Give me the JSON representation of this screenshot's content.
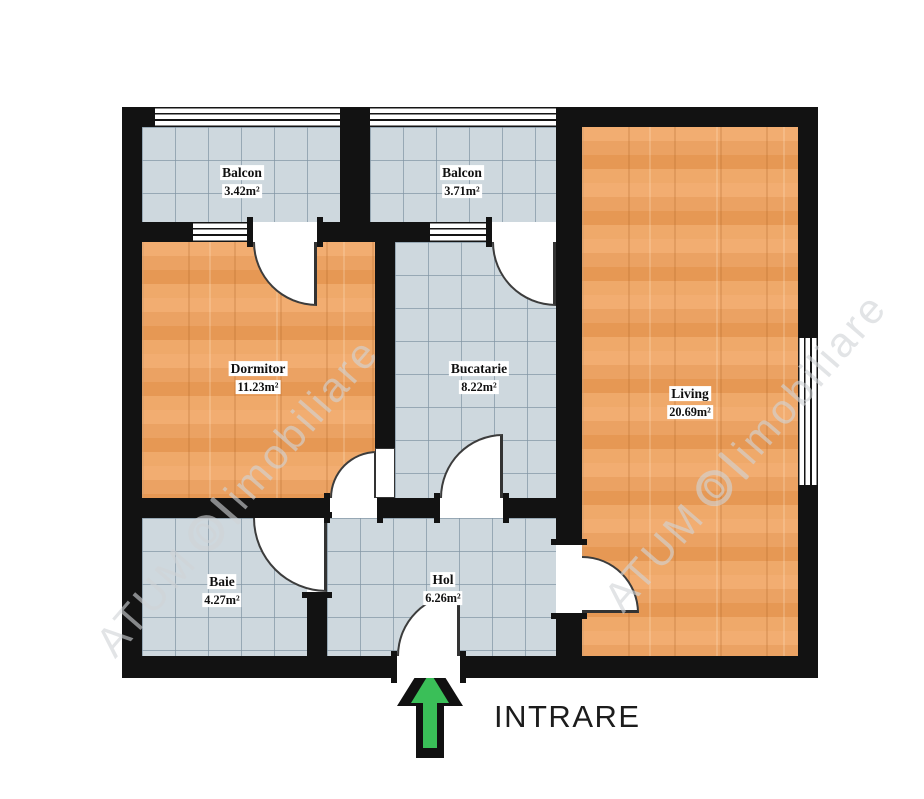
{
  "rooms": [
    {
      "name": "Balcon",
      "area": "3.42m²"
    },
    {
      "name": "Balcon",
      "area": "3.71m²"
    },
    {
      "name": "Dormitor",
      "area": "11.23m²"
    },
    {
      "name": "Bucatarie",
      "area": "8.22m²"
    },
    {
      "name": "Living",
      "area": "20.69m²"
    },
    {
      "name": "Baie",
      "area": "4.27m²"
    },
    {
      "name": "Hol",
      "area": "6.26m²"
    }
  ],
  "entrance": {
    "label": "INTRARE"
  },
  "watermark": {
    "prefix": "ATUM",
    "brand": "imobiliare"
  },
  "colors": {
    "wall": "#121212",
    "tile_floor": "#ced8de",
    "tile_grid": "#8094a3",
    "wood_floor": "#eda466",
    "arrow_green": "#3abf58",
    "arrow_outline": "#111111",
    "text": "#1c1c1c",
    "watermark": "#d0d3d7"
  }
}
